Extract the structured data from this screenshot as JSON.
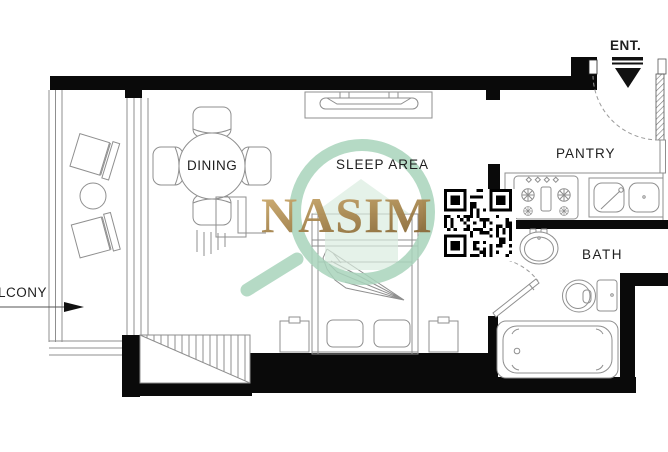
{
  "page": {
    "type": "apartment-floor-plan",
    "background": "#ffffff"
  },
  "labels": {
    "balcony": "LCONY",
    "dining": "DINING",
    "sleep_area": "SLEEP AREA",
    "pantry": "PANTRY",
    "bath": "BATH",
    "entrance": "ENT."
  },
  "rooms": [
    "BALCONY",
    "DINING",
    "SLEEP AREA",
    "PANTRY",
    "BATH",
    "ENTRANCE"
  ],
  "watermark": {
    "brand": "NASIM",
    "logo": "magnifying-glass-with-house",
    "colors": {
      "gold_light": "#c9a76a",
      "gold_dark": "#8a6a38",
      "teal": "#a9d4bc",
      "teal_light": "#d9ecdf"
    }
  },
  "qr_code": {
    "name": "qr-code",
    "modules": 21,
    "seed": 7
  },
  "colors": {
    "wall": "#0a0a0a",
    "line": "#8f8f8f",
    "label": "#1f1f1f",
    "bg": "#ffffff"
  }
}
